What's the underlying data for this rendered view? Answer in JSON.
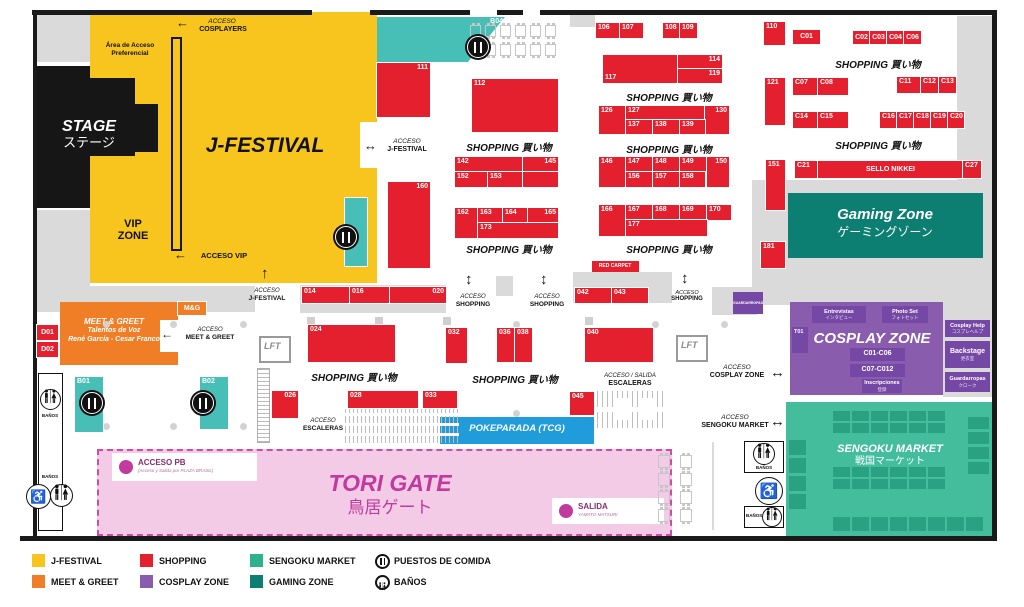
{
  "map": {
    "stage_en": "STAGE",
    "stage_jp": "ステージ",
    "jfestival": "J-FESTIVAL",
    "vip_l1": "VIP",
    "vip_l2": "ZONE",
    "area_pref_l1": "Área de Acceso",
    "area_pref_l2": "Preferencial",
    "shopping_heading": "SHOPPING 買い物",
    "gaming_en": "Gaming Zone",
    "gaming_jp": "ゲーミングゾーン",
    "sengoku_en": "SENGOKU MARKET",
    "sengoku_jp": "戦国マーケット",
    "cosplay_title": "COSPLAY ZONE",
    "tori_en": "TORI GATE",
    "tori_jp": "鳥居ゲート",
    "pokeparada": "POKEPARADA (TCG)",
    "sello_nikkei": "SELLO NIKKEI",
    "red_carpet": "RED CARPET",
    "lft": "LFT",
    "banos": "BAÑOS",
    "meet_title": "MEET & GREET",
    "meet_l2": "Talentos de Voz",
    "meet_l3": "René García - Cesar Franco",
    "acceso_pb": "ACCESO PB",
    "acceso_pb_sub": "(Acceso y Salida por PLAZA BRASIL)",
    "salida": "SALIDA",
    "salida_sub": "YAMATO MATSURI"
  },
  "accesos": {
    "acceso": "ACCESO",
    "cosplayers": "COSPLAYERS",
    "vip": "ACCESO VIP",
    "jfestival": "J-FESTIVAL",
    "shopping": "SHOPPING",
    "meet": "MEET & GREET",
    "escaleras": "ESCALERAS",
    "acceso_salida": "ACCESO / SALIDA",
    "cosplay_zone": "COSPLAY ZONE",
    "sengoku_market": "SENGOKU MARKET"
  },
  "booths": [
    {
      "id": "B04",
      "x": 377,
      "y": 17,
      "w": 128,
      "h": 45,
      "c": "t b04",
      "la": "r"
    },
    {
      "id": "111",
      "x": 377,
      "y": 63,
      "w": 53,
      "h": 54,
      "la": "r"
    },
    {
      "id": "112",
      "x": 472,
      "y": 79,
      "w": 86,
      "h": 53
    },
    {
      "id": "160",
      "x": 388,
      "y": 182,
      "w": 42,
      "h": 86,
      "la": "r"
    },
    {
      "id": "",
      "x": 345,
      "y": 198,
      "w": 22,
      "h": 68,
      "c": "t"
    },
    {
      "id": "142",
      "x": 455,
      "y": 157,
      "w": 68,
      "h": 15
    },
    {
      "id": "145",
      "x": 523,
      "y": 157,
      "w": 35,
      "h": 15,
      "la": "r"
    },
    {
      "id": "152",
      "x": 455,
      "y": 172,
      "w": 33,
      "h": 15
    },
    {
      "id": "153",
      "x": 488,
      "y": 172,
      "w": 35,
      "h": 15
    },
    {
      "id": "",
      "x": 523,
      "y": 172,
      "w": 35,
      "h": 15
    },
    {
      "id": "162",
      "x": 455,
      "y": 208,
      "w": 23,
      "h": 30
    },
    {
      "id": "163",
      "x": 478,
      "y": 208,
      "w": 25,
      "h": 15
    },
    {
      "id": "164",
      "x": 503,
      "y": 208,
      "w": 25,
      "h": 15
    },
    {
      "id": "165",
      "x": 528,
      "y": 208,
      "w": 30,
      "h": 15,
      "la": "r"
    },
    {
      "id": "173",
      "x": 478,
      "y": 223,
      "w": 80,
      "h": 15
    },
    {
      "id": "106",
      "x": 596,
      "y": 23,
      "w": 24,
      "h": 15
    },
    {
      "id": "107",
      "x": 620,
      "y": 23,
      "w": 23,
      "h": 15
    },
    {
      "id": "108",
      "x": 663,
      "y": 23,
      "w": 17,
      "h": 15
    },
    {
      "id": "109",
      "x": 680,
      "y": 23,
      "w": 17,
      "h": 15
    },
    {
      "id": "117",
      "x": 603,
      "y": 55,
      "w": 75,
      "h": 28,
      "la": "bl"
    },
    {
      "id": "114",
      "x": 678,
      "y": 55,
      "w": 44,
      "h": 14,
      "la": "r"
    },
    {
      "id": "119",
      "x": 678,
      "y": 69,
      "w": 44,
      "h": 14,
      "la": "r"
    },
    {
      "id": "126",
      "x": 599,
      "y": 106,
      "w": 27,
      "h": 28
    },
    {
      "id": "127",
      "x": 626,
      "y": 106,
      "w": 79,
      "h": 14
    },
    {
      "id": "130",
      "x": 705,
      "y": 106,
      "w": 24,
      "h": 28,
      "la": "r"
    },
    {
      "id": "137",
      "x": 626,
      "y": 120,
      "w": 27,
      "h": 14
    },
    {
      "id": "138",
      "x": 653,
      "y": 120,
      "w": 27,
      "h": 14
    },
    {
      "id": "139",
      "x": 680,
      "y": 120,
      "w": 25,
      "h": 14
    },
    {
      "id": "146",
      "x": 599,
      "y": 157,
      "w": 27,
      "h": 30
    },
    {
      "id": "147",
      "x": 626,
      "y": 157,
      "w": 27,
      "h": 15
    },
    {
      "id": "148",
      "x": 653,
      "y": 157,
      "w": 27,
      "h": 15
    },
    {
      "id": "149",
      "x": 680,
      "y": 157,
      "w": 27,
      "h": 15
    },
    {
      "id": "150",
      "x": 707,
      "y": 157,
      "w": 22,
      "h": 30,
      "la": "r"
    },
    {
      "id": "156",
      "x": 626,
      "y": 172,
      "w": 27,
      "h": 15
    },
    {
      "id": "157",
      "x": 653,
      "y": 172,
      "w": 27,
      "h": 15
    },
    {
      "id": "158",
      "x": 680,
      "y": 172,
      "w": 25,
      "h": 15
    },
    {
      "id": "166",
      "x": 599,
      "y": 205,
      "w": 27,
      "h": 31
    },
    {
      "id": "167",
      "x": 626,
      "y": 205,
      "w": 27,
      "h": 15
    },
    {
      "id": "168",
      "x": 653,
      "y": 205,
      "w": 27,
      "h": 15
    },
    {
      "id": "169",
      "x": 680,
      "y": 205,
      "w": 27,
      "h": 15
    },
    {
      "id": "170",
      "x": 707,
      "y": 205,
      "w": 24,
      "h": 15
    },
    {
      "id": "177",
      "x": 626,
      "y": 220,
      "w": 81,
      "h": 16
    },
    {
      "id": "110",
      "x": 764,
      "y": 22,
      "w": 21,
      "h": 23
    },
    {
      "id": "121",
      "x": 765,
      "y": 78,
      "w": 20,
      "h": 47
    },
    {
      "id": "151",
      "x": 766,
      "y": 160,
      "w": 19,
      "h": 50
    },
    {
      "id": "181",
      "x": 761,
      "y": 242,
      "w": 24,
      "h": 26
    },
    {
      "id": "C01",
      "x": 793,
      "y": 30,
      "w": 27,
      "h": 14,
      "la": "c"
    },
    {
      "id": "C02",
      "x": 853,
      "y": 31,
      "w": 17,
      "h": 13,
      "la": "c"
    },
    {
      "id": "C03",
      "x": 870,
      "y": 31,
      "w": 17,
      "h": 13,
      "la": "c"
    },
    {
      "id": "C04",
      "x": 887,
      "y": 31,
      "w": 17,
      "h": 13,
      "la": "c"
    },
    {
      "id": "C06",
      "x": 904,
      "y": 31,
      "w": 17,
      "h": 13,
      "la": "c"
    },
    {
      "id": "C07",
      "x": 793,
      "y": 78,
      "w": 25,
      "h": 17
    },
    {
      "id": "C08",
      "x": 818,
      "y": 78,
      "w": 30,
      "h": 17
    },
    {
      "id": "C11",
      "x": 897,
      "y": 77,
      "w": 24,
      "h": 16
    },
    {
      "id": "C12",
      "x": 921,
      "y": 77,
      "w": 18,
      "h": 16
    },
    {
      "id": "C13",
      "x": 939,
      "y": 77,
      "w": 17,
      "h": 16
    },
    {
      "id": "C14",
      "x": 793,
      "y": 112,
      "w": 25,
      "h": 16
    },
    {
      "id": "C15",
      "x": 818,
      "y": 112,
      "w": 30,
      "h": 16
    },
    {
      "id": "C16",
      "x": 880,
      "y": 112,
      "w": 17,
      "h": 16
    },
    {
      "id": "C17",
      "x": 897,
      "y": 112,
      "w": 17,
      "h": 16
    },
    {
      "id": "C18",
      "x": 914,
      "y": 112,
      "w": 17,
      "h": 16
    },
    {
      "id": "C19",
      "x": 931,
      "y": 112,
      "w": 17,
      "h": 16
    },
    {
      "id": "C20",
      "x": 948,
      "y": 112,
      "w": 16,
      "h": 16
    },
    {
      "id": "C21",
      "x": 795,
      "y": 161,
      "w": 23,
      "h": 17
    },
    {
      "id": "SELLO NIKKEI",
      "x": 818,
      "y": 161,
      "w": 145,
      "h": 17,
      "la": "c"
    },
    {
      "id": "C27",
      "x": 963,
      "y": 161,
      "w": 18,
      "h": 17
    },
    {
      "id": "014",
      "x": 302,
      "y": 287,
      "w": 48,
      "h": 16
    },
    {
      "id": "016",
      "x": 350,
      "y": 287,
      "w": 40,
      "h": 16
    },
    {
      "id": "020",
      "x": 390,
      "y": 287,
      "w": 56,
      "h": 16,
      "la": "r"
    },
    {
      "id": "024",
      "x": 308,
      "y": 325,
      "w": 87,
      "h": 37
    },
    {
      "id": "026",
      "x": 272,
      "y": 391,
      "w": 26,
      "h": 27,
      "la": "r"
    },
    {
      "id": "028",
      "x": 348,
      "y": 391,
      "w": 70,
      "h": 17
    },
    {
      "id": "033",
      "x": 423,
      "y": 391,
      "w": 34,
      "h": 17
    },
    {
      "id": "032",
      "x": 446,
      "y": 328,
      "w": 21,
      "h": 35
    },
    {
      "id": "036",
      "x": 497,
      "y": 328,
      "w": 18,
      "h": 34
    },
    {
      "id": "038",
      "x": 515,
      "y": 328,
      "w": 17,
      "h": 34
    },
    {
      "id": "040",
      "x": 585,
      "y": 328,
      "w": 68,
      "h": 34
    },
    {
      "id": "042",
      "x": 575,
      "y": 288,
      "w": 36,
      "h": 15
    },
    {
      "id": "043",
      "x": 612,
      "y": 288,
      "w": 36,
      "h": 15
    },
    {
      "id": "045",
      "x": 570,
      "y": 392,
      "w": 24,
      "h": 23
    },
    {
      "id": "D01",
      "x": 37,
      "y": 325,
      "w": 21,
      "h": 15,
      "la": "c"
    },
    {
      "id": "D02",
      "x": 37,
      "y": 342,
      "w": 21,
      "h": 15,
      "la": "c"
    },
    {
      "id": "M&G",
      "x": 178,
      "y": 302,
      "w": 28,
      "h": 13,
      "c": "o",
      "la": "c"
    },
    {
      "id": "B01",
      "x": 75,
      "y": 377,
      "w": 28,
      "h": 55,
      "c": "t"
    },
    {
      "id": "B02",
      "x": 200,
      "y": 377,
      "w": 28,
      "h": 52,
      "c": "t"
    }
  ],
  "cosplay_boxes": [
    {
      "t": "Entrevistas",
      "s": "インタビュー",
      "x": 812,
      "y": 306,
      "w": 54,
      "h": 17
    },
    {
      "t": "Photo Set",
      "s": "フォトセット",
      "x": 882,
      "y": 306,
      "w": 46,
      "h": 17
    },
    {
      "t": "T01",
      "s": "",
      "x": 792,
      "y": 327,
      "w": 16,
      "h": 26,
      "tl": true
    },
    {
      "t": "C01-C06",
      "s": "",
      "x": 850,
      "y": 348,
      "w": 55,
      "h": 13,
      "big": true
    },
    {
      "t": "C07-C012",
      "s": "",
      "x": 850,
      "y": 364,
      "w": 55,
      "h": 13,
      "big": true
    },
    {
      "t": "Inscripciones",
      "s": "登録",
      "x": 862,
      "y": 379,
      "w": 40,
      "h": 14
    },
    {
      "t": "Cosplay Help",
      "s": "コスプレヘルプ",
      "x": 945,
      "y": 320,
      "w": 45,
      "h": 17
    },
    {
      "t": "Backstage",
      "s": "更衣室",
      "x": 945,
      "y": 341,
      "w": 45,
      "h": 27,
      "big": true
    },
    {
      "t": "Guardarropas",
      "s": "クローク",
      "x": 945,
      "y": 372,
      "w": 45,
      "h": 20
    },
    {
      "t": "GUARDARROPAS",
      "s": "",
      "x": 733,
      "y": 292,
      "w": 30,
      "h": 22,
      "tiny": true
    }
  ],
  "sengoku_grids": [
    {
      "x": 833,
      "y": 411,
      "rows": 2,
      "cols": 6,
      "cw": 17,
      "ch": 10,
      "gx": 2,
      "gy": 2
    },
    {
      "x": 833,
      "y": 467,
      "rows": 2,
      "cols": 6,
      "cw": 17,
      "ch": 10,
      "gx": 2,
      "gy": 2
    },
    {
      "x": 833,
      "y": 517,
      "rows": 1,
      "cols": 8,
      "cw": 17,
      "ch": 14,
      "gx": 2,
      "gy": 2
    },
    {
      "x": 789,
      "y": 440,
      "rows": 4,
      "cols": 1,
      "cw": 17,
      "ch": 15,
      "gx": 2,
      "gy": 3
    },
    {
      "x": 968,
      "y": 417,
      "rows": 4,
      "cols": 1,
      "cw": 21,
      "ch": 12,
      "gx": 2,
      "gy": 3
    }
  ],
  "table_grids": [
    {
      "x": 470,
      "y": 25,
      "rows": 2,
      "cols": 6,
      "cw": 11,
      "ch": 12,
      "gx": 4,
      "gy": 7
    },
    {
      "x": 658,
      "y": 455,
      "rows": 4,
      "cols": 2,
      "cw": 12,
      "ch": 13,
      "gx": 10,
      "gy": 5
    }
  ],
  "food_spots": [
    {
      "x": 478,
      "y": 47
    },
    {
      "x": 346,
      "y": 237
    },
    {
      "x": 92,
      "y": 403
    },
    {
      "x": 203,
      "y": 403
    }
  ],
  "legend": {
    "items": [
      {
        "label": "J-FESTIVAL",
        "swatch": "#F7C51E",
        "col": 0,
        "row": 0
      },
      {
        "label": "MEET & GREET",
        "swatch": "#F07E26",
        "col": 0,
        "row": 1
      },
      {
        "label": "SHOPPING",
        "swatch": "#E5202E",
        "col": 1,
        "row": 0
      },
      {
        "label": "COSPLAY ZONE",
        "swatch": "#8A5CAD",
        "col": 1,
        "row": 1
      },
      {
        "label": "SENGOKU MARKET",
        "swatch": "#2EB18C",
        "col": 2,
        "row": 0
      },
      {
        "label": "GAMING ZONE",
        "swatch": "#0C7F72",
        "col": 2,
        "row": 1
      },
      {
        "label": "PUESTOS DE COMIDA",
        "icon": "food",
        "col": 3,
        "row": 0
      },
      {
        "label": "BAÑOS",
        "icon": "banos",
        "col": 3,
        "row": 1
      }
    ]
  }
}
